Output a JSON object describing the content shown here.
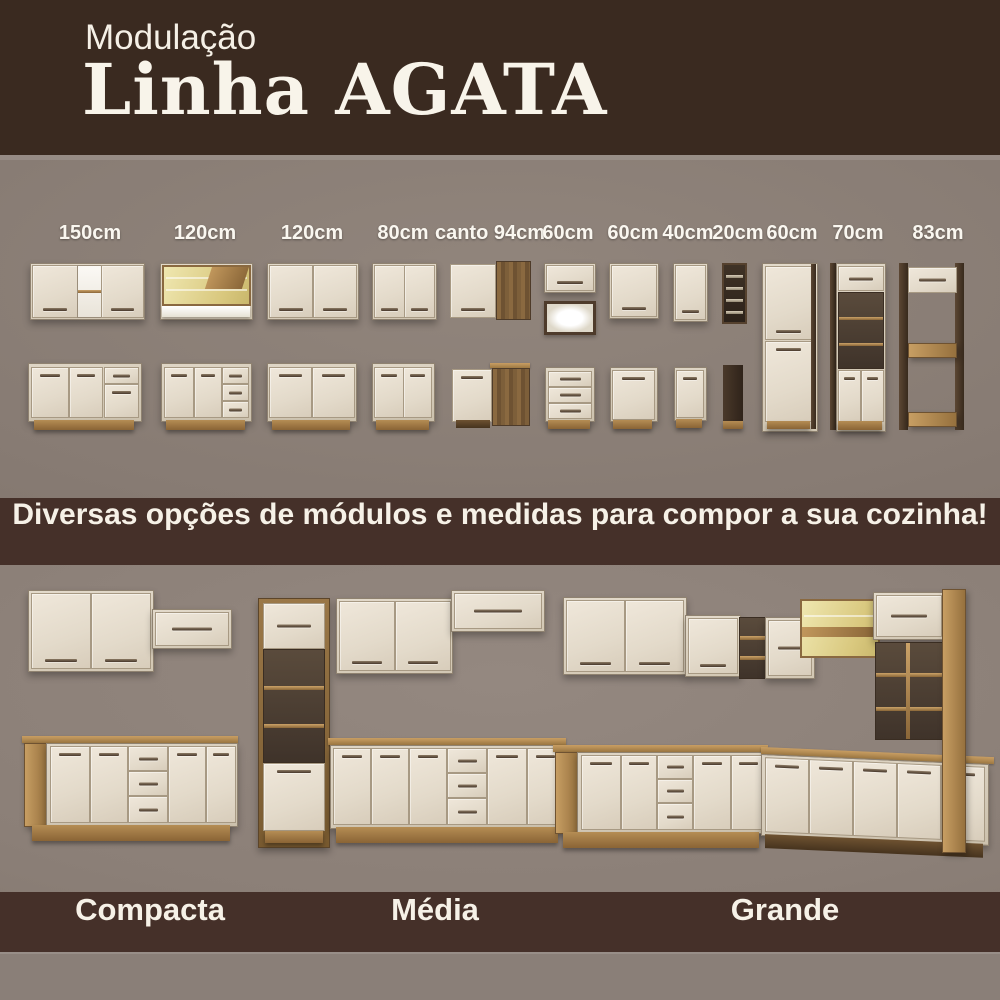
{
  "header": {
    "eyebrow": "Modulação",
    "title": "Linha AGATA"
  },
  "banner": {
    "text": "Diversas opções de módulos e medidas para compor a sua cozinha!"
  },
  "modules": {
    "items": [
      {
        "label": "150cm",
        "type": "wall cabinet 2 doors + open shelf / base 2 doors + drawer"
      },
      {
        "label": "120cm",
        "type": "wall glass-door lighted cabinet / base 2 doors + 3 drawers"
      },
      {
        "label": "120cm",
        "type": "wall cabinet 2 doors / base 2 doors"
      },
      {
        "label": "80cm",
        "type": "wall cabinet 2 doors / base 2 doors"
      },
      {
        "label": "canto 94cm",
        "type": "corner wall cabinet / corner base cabinet"
      },
      {
        "label": "60cm",
        "type": "flip-up wall cabinet + lighted niche / base 3 drawers"
      },
      {
        "label": "60cm",
        "type": "wall cabinet 1 door / base 1 door"
      },
      {
        "label": "40cm",
        "type": "narrow wall cabinet / narrow base cabinet"
      },
      {
        "label": "20cm",
        "type": "bottle rack / open niche"
      },
      {
        "label": "60cm",
        "type": "tall pantry 2 doors"
      },
      {
        "label": "70cm",
        "type": "tall oven tower with niche"
      },
      {
        "label": "83cm",
        "type": "tall refrigerator frame"
      }
    ]
  },
  "kitchens": {
    "items": [
      {
        "label": "Compacta"
      },
      {
        "label": "Média"
      },
      {
        "label": "Grande"
      }
    ]
  },
  "colors": {
    "header_brown": "#3A2A20",
    "band_brown": "#453029",
    "background_gray": "#877C74",
    "door_cream": "#E4DBCC",
    "wood_oak": "#A8834E",
    "wood_dark": "#4E3A2A",
    "text_cream": "#F6F1E7"
  }
}
